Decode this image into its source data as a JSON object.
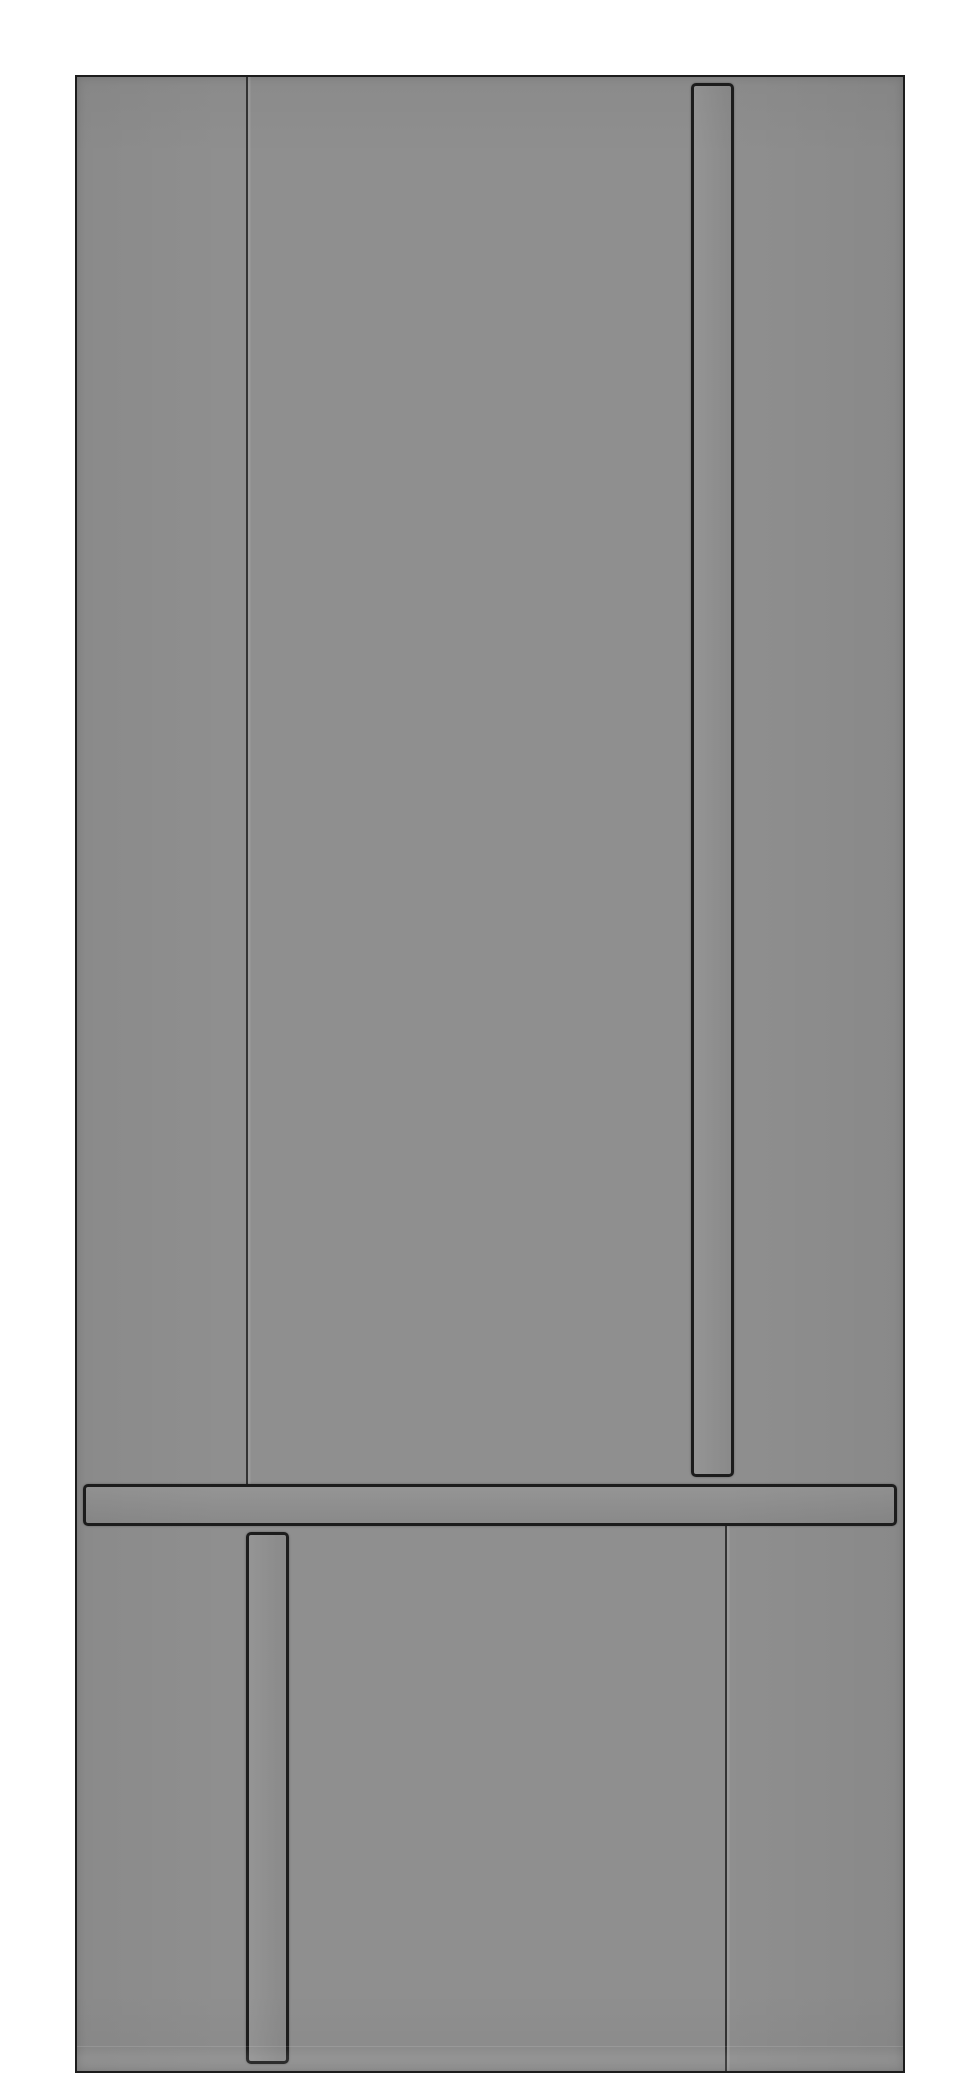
{
  "image": {
    "subject": "grayscale 3D render of an integrated refrigerator front panel",
    "background": "#ffffff"
  },
  "colors": {
    "bg": "#ffffff",
    "panel": "#8f8f8f",
    "outline": "#1c1c1c"
  },
  "geometry": {
    "panel": {
      "x": 75,
      "y": 75,
      "w": 830,
      "h": 1998
    },
    "upper_seam": {
      "x": 246,
      "y": 77,
      "w": 5,
      "h": 1407
    },
    "upper_handle": {
      "x": 691,
      "y": 83,
      "w": 43,
      "h": 1394
    },
    "rail": {
      "x": 83,
      "y": 1484,
      "w": 814,
      "h": 42
    },
    "lower_seam": {
      "x": 725,
      "y": 1526,
      "w": 5,
      "h": 545
    },
    "lower_handle": {
      "x": 246,
      "y": 1532,
      "w": 43,
      "h": 532
    },
    "bottom_shade": {
      "x": 77,
      "y": 2046,
      "w": 826,
      "h": 25
    }
  }
}
